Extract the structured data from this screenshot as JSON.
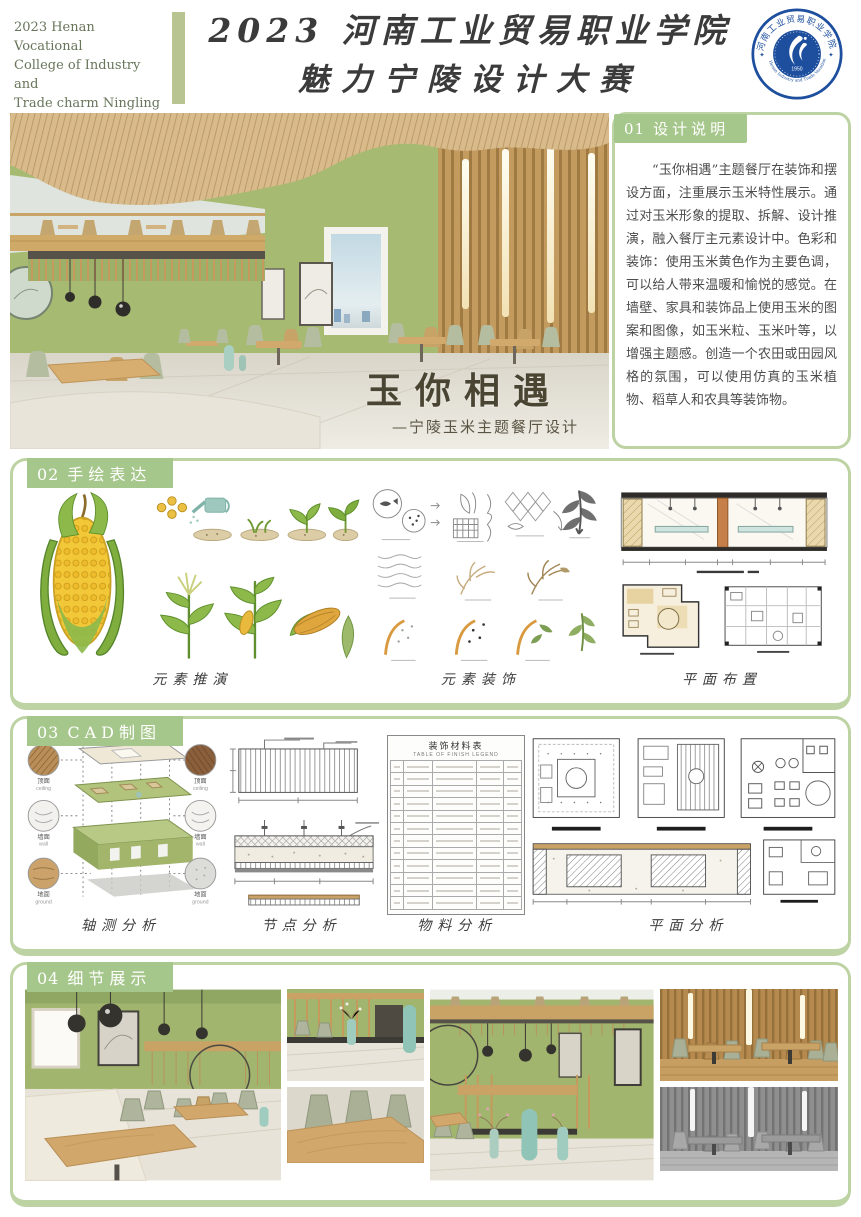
{
  "header": {
    "caption_lines": [
      "2023 Henan Vocational",
      "College of Industry and",
      "Trade charm Ningling",
      "design Competition"
    ],
    "title_line1": "2023 河南工业贸易职业学院",
    "title_line2": "魅力宁陵设计大赛",
    "logo": {
      "ring_top": "河南工业贸易职业学院",
      "ring_bottom": "Henan Industry and Trade Vocational College",
      "year": "1950",
      "color": "#1d4f9e"
    }
  },
  "hero": {
    "overlay_title": "玉你相遇",
    "overlay_subtitle": "—宁陵玉米主题餐厅设计"
  },
  "design_note": {
    "number": "01",
    "title": "设计说明",
    "body": "“玉你相遇”主题餐厅在装饰和摆设方面，注重展示玉米特性展示。通过对玉米形象的提取、拆解、设计推演，融入餐厅主元素设计中。色彩和装饰：使用玉米黄色作为主要色调，可以给人带来温暖和愉悦的感觉。在墙壁、家具和装饰品上使用玉米的图案和图像，如玉米粒、玉米叶等，以增强主题感。创造一个农田或田园风格的氛围，可以使用仿真的玉米植物、稻草人和农具等装饰物。"
  },
  "section02": {
    "number": "02",
    "title": "手绘表达",
    "labels": [
      "元素推演",
      "元素装饰",
      "平面布置"
    ]
  },
  "section03": {
    "number": "03",
    "title": "CAD制图",
    "labels": [
      "轴测分析",
      "节点分析",
      "物料分析",
      "平面分析"
    ],
    "materials": [
      {
        "cn": "顶面",
        "en": "ceiling"
      },
      {
        "cn": "墙面",
        "en": "wall"
      },
      {
        "cn": "地面",
        "en": "ground"
      }
    ],
    "table": {
      "title": "装饰材料表",
      "subtitle": "TABLE OF FINISH LEGEND"
    }
  },
  "section04": {
    "number": "04",
    "title": "细节展示"
  },
  "colors": {
    "accent_green": "#a6c78b",
    "border_green": "#bdd3a4",
    "wall_green": "#a6ba72",
    "wood": "#cda66a",
    "logo_blue": "#1d4f9e"
  }
}
